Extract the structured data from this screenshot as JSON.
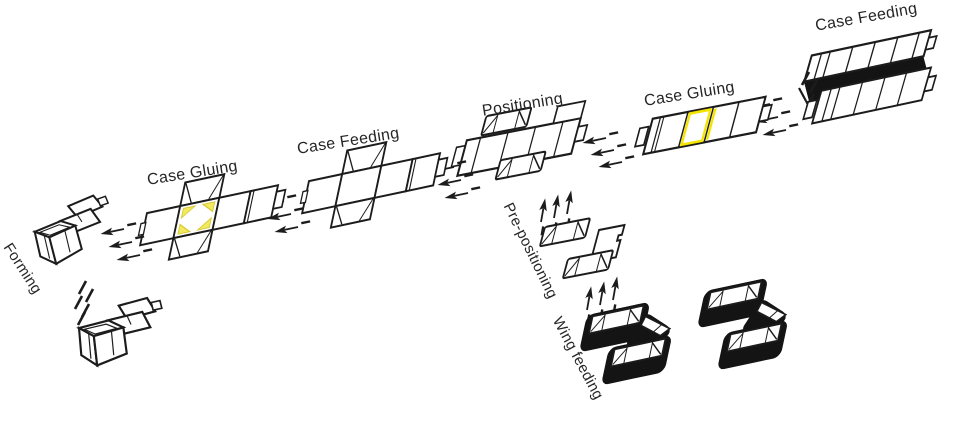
{
  "diagram": {
    "type": "process-flow",
    "subject": "carton forming line",
    "labels": {
      "case_feeding_top": "Case Feeding",
      "case_gluing_right": "Case Gluing",
      "positioning": "Positioning",
      "case_feeding_mid": "Case Feeding",
      "case_gluing_left": "Case Gluing",
      "forming": "Forming",
      "pre_positioning": "Pre-positioning",
      "wing_feeding": "Wing feeding"
    },
    "flow_order": [
      "Case Feeding",
      "Case Gluing",
      "Positioning",
      "Case Feeding",
      "Case Gluing",
      "Forming"
    ],
    "side_flow_order": [
      "Wing feeding",
      "Pre-positioning",
      "Positioning"
    ],
    "colors": {
      "line": "#1c1c1c",
      "dark_fill": "#141414",
      "glue_strong": "#f4e400",
      "glue_soft": "#f2e95e",
      "background": "#ffffff",
      "label_text": "#262626"
    },
    "icons": {
      "flow_arrow": "left-flow-arrow-icon",
      "lift_arrow": "up-flow-arrow-icon",
      "motion_tick": "motion-slash-icon"
    }
  }
}
